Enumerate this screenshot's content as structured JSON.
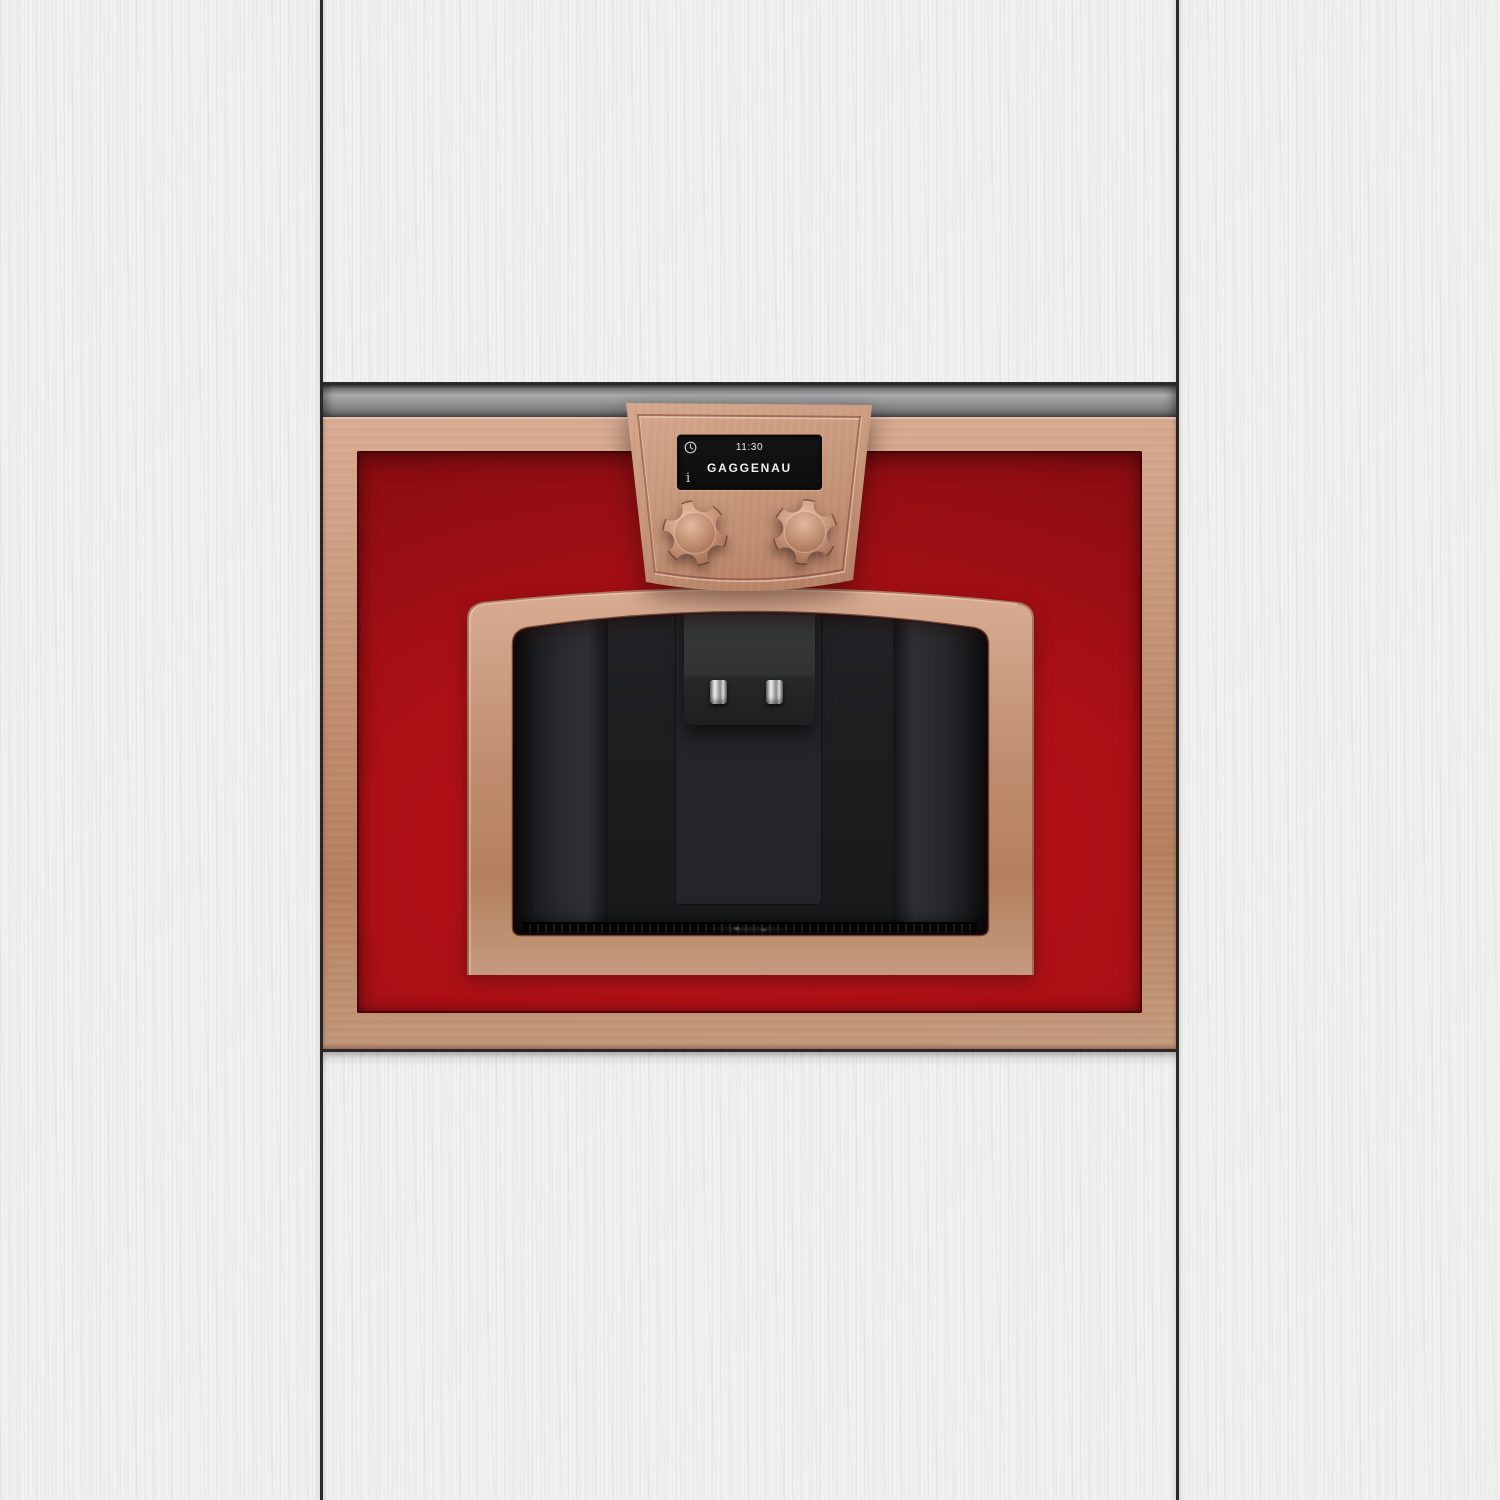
{
  "scene": {
    "subject": "Built-in coffee machine with copper frames and red glass panel set into white wood-grain kitchen cabinetry"
  },
  "control_panel": {
    "display": {
      "time": "11:30",
      "brand_logo": "GAGGENAU",
      "clock_icon": "clock-icon",
      "info_icon": "info-icon",
      "info_icon_glyph": "i"
    },
    "knobs": [
      {
        "name": "left-knob"
      },
      {
        "name": "right-knob"
      }
    ]
  },
  "dispenser": {
    "nozzles": [
      "nozzle-left",
      "nozzle-right"
    ],
    "drip_tray": "drip-tray-grille"
  },
  "colors": {
    "cabinet_white": "#f2f1ef",
    "seam_dark": "#29292b",
    "rail_silver_light": "#a9abad",
    "rail_silver_dark": "#515356",
    "copper_light": "#d9ad93",
    "copper_mid": "#c08d70",
    "copper_mid2": "#c49a7e",
    "copper_dark": "#9e6b54",
    "panel_copper_light": "#d6a98f",
    "panel_copper_dark": "#b27c62",
    "glass_red": "#ac1015",
    "glass_red_deep": "#7e0c10",
    "cavity_black": "#18191b",
    "cavity_wall": "#2e3033",
    "spout_gray": "#37393b",
    "spout_dark": "#1d1f21",
    "nozzle_silver": "#d8d8da",
    "display_black": "#121212",
    "display_text": "#ebe9e5"
  }
}
